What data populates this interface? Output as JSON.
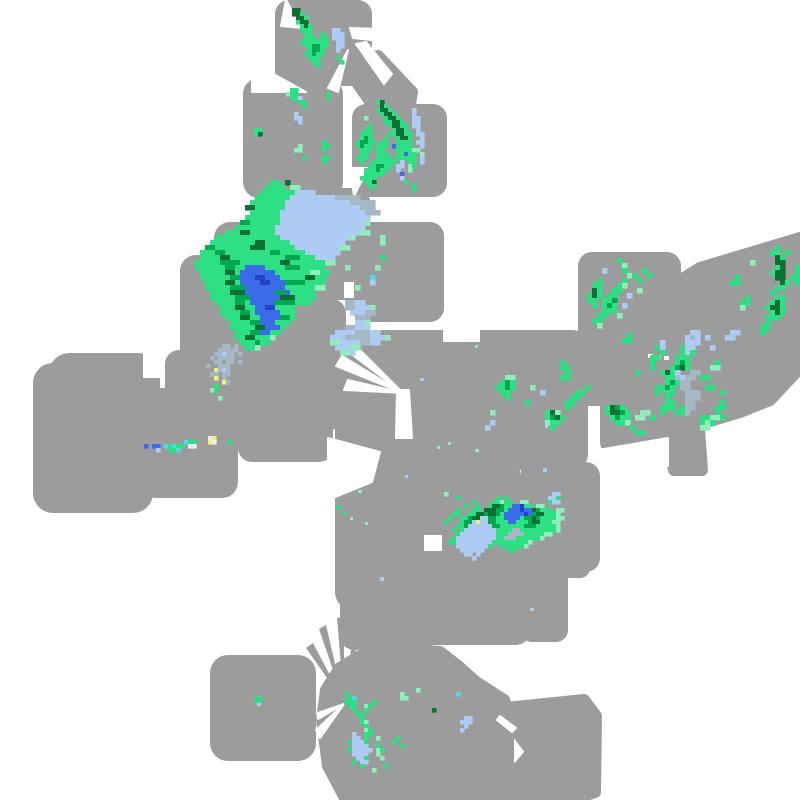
{
  "canvas": {
    "width": 800,
    "height": 800,
    "background": "#ffffff"
  },
  "palette": {
    "footprint": "#9c9c9c",
    "gap": "#ffffff",
    "b": "#aecbf3",
    "s": "#a6b7c6",
    "g": "#2ee084",
    "G": "#00a84f",
    "D": "#0b7034",
    "B": "#3a6be8",
    "N": "#2343c6",
    "c": "#52d8e6",
    "m": "#90eebb",
    "y": "#eef17c",
    "w": "#e9eff5"
  },
  "footprint_rects": [
    [
      275,
      0,
      97,
      86,
      14
    ],
    [
      243,
      78,
      100,
      120,
      16
    ],
    [
      352,
      104,
      95,
      93,
      14
    ],
    [
      266,
      188,
      104,
      112,
      14
    ],
    [
      214,
      222,
      118,
      120,
      16
    ],
    [
      180,
      255,
      106,
      130,
      16
    ],
    [
      228,
      298,
      118,
      132,
      16
    ],
    [
      238,
      380,
      95,
      82,
      14
    ],
    [
      352,
      222,
      92,
      100,
      14
    ],
    [
      335,
      330,
      185,
      145,
      16
    ],
    [
      470,
      330,
      118,
      140,
      16
    ],
    [
      600,
      336,
      66,
      118,
      12
    ],
    [
      584,
      336,
      22,
      74,
      6
    ],
    [
      578,
      252,
      103,
      100,
      14
    ],
    [
      335,
      455,
      185,
      155,
      18
    ],
    [
      520,
      462,
      80,
      110,
      14
    ],
    [
      520,
      560,
      48,
      82,
      12
    ],
    [
      540,
      548,
      50,
      30,
      10
    ],
    [
      340,
      555,
      95,
      95,
      14
    ],
    [
      390,
      560,
      140,
      85,
      14
    ],
    [
      210,
      655,
      106,
      106,
      18
    ],
    [
      33,
      363,
      120,
      150,
      20
    ],
    [
      48,
      353,
      112,
      100,
      22
    ],
    [
      140,
      388,
      98,
      110,
      16
    ],
    [
      165,
      350,
      75,
      55,
      14
    ]
  ],
  "footprint_polys": [
    [
      [
        358,
        62
      ],
      [
        378,
        56
      ],
      [
        412,
        92
      ],
      [
        410,
        104
      ],
      [
        372,
        104
      ],
      [
        358,
        84
      ]
    ],
    [
      [
        655,
        315
      ],
      [
        668,
        288
      ],
      [
        700,
        268
      ],
      [
        800,
        238
      ],
      [
        800,
        368
      ],
      [
        770,
        400
      ],
      [
        740,
        412
      ],
      [
        700,
        424
      ],
      [
        668,
        430
      ],
      [
        648,
        420
      ],
      [
        640,
        390
      ],
      [
        642,
        345
      ]
    ],
    [
      [
        664,
        428
      ],
      [
        698,
        416
      ],
      [
        702,
        470
      ],
      [
        674,
        470
      ]
    ],
    [
      [
        326,
        690
      ],
      [
        340,
        668
      ],
      [
        360,
        656
      ],
      [
        386,
        652
      ],
      [
        412,
        650
      ],
      [
        440,
        652
      ],
      [
        458,
        666
      ],
      [
        476,
        682
      ],
      [
        504,
        700
      ],
      [
        508,
        712
      ],
      [
        508,
        800
      ],
      [
        346,
        800
      ],
      [
        328,
        766
      ],
      [
        322,
        720
      ]
    ],
    [
      [
        506,
        708
      ],
      [
        584,
        700
      ],
      [
        596,
        716
      ],
      [
        595,
        792
      ],
      [
        572,
        800
      ],
      [
        520,
        800
      ],
      [
        508,
        780
      ],
      [
        532,
        752
      ],
      [
        506,
        718
      ]
    ]
  ],
  "gap_rects": [
    [
      344,
      282,
      10,
      16
    ],
    [
      424,
      535,
      18,
      16
    ],
    [
      588,
      406,
      12,
      48
    ],
    [
      143,
      350,
      20,
      28
    ],
    [
      443,
      320,
      37,
      22
    ],
    [
      648,
      354,
      5,
      4
    ],
    [
      656,
      355,
      5,
      4
    ],
    [
      664,
      356,
      5,
      4
    ]
  ],
  "gap_polys": [
    [
      [
        286,
        0
      ],
      [
        281,
        26
      ],
      [
        302,
        28
      ]
    ],
    [
      [
        350,
        28
      ],
      [
        380,
        29
      ],
      [
        380,
        41
      ],
      [
        353,
        38
      ]
    ],
    [
      [
        348,
        50
      ],
      [
        328,
        88
      ],
      [
        338,
        92
      ]
    ],
    [
      [
        356,
        44
      ],
      [
        366,
        42
      ],
      [
        392,
        74
      ],
      [
        384,
        84
      ]
    ],
    [
      [
        252,
        62
      ],
      [
        306,
        92
      ],
      [
        252,
        92
      ]
    ],
    [
      [
        350,
        168
      ],
      [
        368,
        168
      ],
      [
        354,
        196
      ]
    ],
    [
      [
        403,
        393
      ],
      [
        338,
        344
      ],
      [
        350,
        340
      ]
    ],
    [
      [
        403,
        393
      ],
      [
        342,
        356
      ],
      [
        336,
        366
      ]
    ],
    [
      [
        403,
        393
      ],
      [
        348,
        380
      ],
      [
        344,
        390
      ]
    ],
    [
      [
        397,
        390
      ],
      [
        409,
        390
      ],
      [
        412,
        438
      ],
      [
        396,
        438
      ]
    ],
    [
      [
        500,
        716
      ],
      [
        516,
        728
      ],
      [
        512,
        732
      ],
      [
        497,
        720
      ]
    ],
    [
      [
        598,
        466
      ],
      [
        598,
        450
      ],
      [
        668,
        438
      ],
      [
        668,
        466
      ]
    ],
    [
      [
        328,
        438
      ],
      [
        380,
        452
      ],
      [
        372,
        482
      ],
      [
        328,
        500
      ]
    ],
    [
      [
        344,
        704
      ],
      [
        318,
        713
      ],
      [
        318,
        719
      ]
    ],
    [
      [
        344,
        704
      ],
      [
        316,
        730
      ],
      [
        320,
        738
      ]
    ]
  ],
  "sliver_polys": [
    [
      [
        344,
        702
      ],
      [
        306,
        648
      ],
      [
        313,
        643
      ]
    ],
    [
      [
        344,
        702
      ],
      [
        319,
        629
      ],
      [
        326,
        625
      ]
    ],
    [
      [
        344,
        702
      ],
      [
        337,
        618
      ],
      [
        344,
        617
      ]
    ],
    [
      [
        344,
        702
      ],
      [
        355,
        619
      ],
      [
        362,
        622
      ]
    ],
    [
      [
        344,
        702
      ],
      [
        373,
        632
      ],
      [
        379,
        638
      ]
    ]
  ],
  "echo_regions": [
    {
      "name": "echo-north-cell",
      "x": 288,
      "y": 8,
      "cell": 4,
      "rows": [
        ".DD.............",
        ".DDg............",
        "..DDg...........",
        "..gDD...........",
        "...gDg..........",
        "...ggg.....bb...",
        "....gg..g..bbb..",
        "....ggg.gg.bbb..",
        "...ggggggg..bb..",
        "....ggGGgg..bb..",
        ".....gGGg...b...",
        "....ggGgg.......",
        ".....ggg....g...",
        "......gg.....g..",
        ".......g........"
      ]
    },
    {
      "name": "echo-square-b",
      "x": 250,
      "y": 88,
      "cell": 4,
      "rows": [
        "..........gg..........",
        ".........mgg.......g..",
        "..........ggb......g..",
        "............gg........",
        ".............g........",
        "......................",
        "...........b..........",
        "...........bb.........",
        "............b.........",
        "......................",
        ".gg...................",
        ".gD...................",
        "......................",
        "..................g...",
        "............m.....gg..",
        "...........mm.....g...",
        "......................",
        ".............g....gg..",
        "..................g...",
        "......................"
      ]
    },
    {
      "name": "echo-square-c",
      "x": 352,
      "y": 100,
      "cell": 4,
      "rows": [
        "......gD................",
        ".......Dg...............",
        "......gDDg.....b........",
        ".......gDDg....b........",
        "...m....gDDg...bb.......",
        "........ggDDg..bb.......",
        "....g....gDDgg.bb.......",
        "...gg.....gDDg..b.......",
        "..ggg....ggDDgg.bb......",
        "..gGg...g..gDDg..b......",
        ".gGGgg.gg..gggg.bb......",
        ".gGgg.ggg.Bgggg..b......",
        "..ggg.gg...ggggmm.......",
        "..gg..ggg..ggBgg.m......",
        ".ggg..gggg.ggggg.b......",
        "..g..gggggg.b.gg.b......",
        "....ggGGgg.bb.mg........",
        "...gggGgg..b..m.........",
        "...ggggg....B...........",
        "..gggg......b...........",
        "...ggD.......g..........",
        "....gg.........g........",
        "...............g........"
      ]
    },
    {
      "name": "echo-central-storm-complex",
      "x": 180,
      "y": 180,
      "cell": 5,
      "rows": [
        "..................gg.D....................",
        ".................gggg.mm..................",
        "................gggggggbbbb...............",
        "...............gggggggbbbbbbbbbsssss......",
        "..............gggggggbbbbbbbbbbbbbsssss...",
        ".............DDggggggbbbbbbbbbbbbbbbsss...",
        "..............ggggggbbbbbbbbbbbbbbbbbsss..",
        ".............gggggggbbbbbbbbbbbbbbbbbb....",
        "............GGggggggbbbbbbbbbbbbbbbbbm....",
        "...........ggggggggbbbbbbbbbbbbbbbbbb.....",
        ".........gggDDgggggbbbbbbbbbbbbbbbbbmm....",
        ".......gggggggggggggbbbbbbbbbbbbbbm.....m.",
        "......gggggggggDDgggggbbbbbbbbbbb.......m.",
        ".....GGgggggggDDDggggggbbbbbbbbbmm........",
        "....gggGGgggggggggGGgggggbbbbbbb..........",
        "....ggggDDgggggggggggGGGgggbbbb.........g.",
        "...gggggGGGGggggggggDDgggggggmm...........",
        "...ggggggGGggBBBBggggGGGggggg....m.....m..",
        "....gggggDDgBBBBBBBgggggggmmgg............",
        "....ggggggGGBBBNNBBBgggggDDgg.........c...",
        ".....ggggDDgBBBBNNBBBGGGGgggg.........b...",
        ".....gggggGGGBBBBBBBBggggggmm......m......",
        "......ggggDDDBBBBBBGGBggggg...............",
        "......gggggGGGBBBBBBDDDgggg...............",
        ".......ggggGGgBBBBBGGGGggg.......ssbb.....",
        "........gggDDggBBNNgggg..........ssbbbm...",
        "........ggggGGgBBBBBggg...........bbbss...",
        ".........gggDDggBBBBGGg............sss....",
        "..........ggggGGBBBggg.............bbm....",
        "..........gggggDDBBBg............ssbbb....",
        "...........gggGGBBgg...........bbbbsssbb..",
        "...........ggDDgggm...........bbbsssssbbbm",
        "............gggGgg............mmbbbbssbb..",
        ".............ggm...............bbbmm......",
        "................................mmb......."
      ]
    },
    {
      "name": "echo-slate-patch",
      "x": 198,
      "y": 344,
      "cell": 4,
      "rows": [
        "......ss.s......",
        ".....sssss......",
        "....ssbss.s.....",
        "...s.ssss.......",
        "....ss.ss.s.....",
        "..s..sss........",
        "....ysbs........",
        "...ss.ss........",
        "....y.s.........",
        "......ys........",
        "....g...........",
        "...mg...........",
        "................",
        ".....m..........",
        "................"
      ]
    },
    {
      "name": "echo-thin-line",
      "x": 140,
      "y": 436,
      "cell": 4,
      "rows": [
        ".................wy......",
        "...........cgg...yw...g..",
        ".B.BB.cgcgg.ww...........",
        "....b..ggc...............",
        "........................."
      ]
    },
    {
      "name": "echo-east-streaks",
      "x": 582,
      "y": 258,
      "cell": 5,
      "rows": [
        ".......g............",
        "........m...........",
        "....b...g...g.......",
        ".........mg..g......",
        "...g....g..g........",
        "..gg...gm...........",
        "..Dg..gg...m........",
        ".gDg.gg..b..........",
        ".gg.ggG.............",
        "..g.gGg.b...........",
        "....ggg.............",
        "...gg..m............",
        "..gg................",
        "...m................",
        "....................",
        ".........g..........",
        "........gg.........."
      ]
    },
    {
      "name": "echo-northeast-streaks",
      "x": 720,
      "y": 245,
      "cell": 5,
      "rows": [
        "...........g....",
        "..........gg.g..",
        "...........Dg...",
        "......m....DD...",
        "...........gD..g",
        "..........gDD..g",
        "...g.......DD.gg",
        "..gg........Dg.g",
        "...........gg...",
        "..........g.....",
        ".....g.....gg...",
        "....gg....gDg...",
        "....m....gDDg...",
        "..........gDg...",
        ".........ggg....",
        ".........g......",
        "........gg......",
        "..bb....g.......",
        ".bb.............",
        "................"
      ]
    },
    {
      "name": "echo-east-band",
      "x": 560,
      "y": 330,
      "cell": 5,
      "rows": [
        "..........................bb............",
        ".........................bsb.b..........",
        "....................b....bbb............",
        "...................gb...gbb...b.........",
        "....................g...gbg.............",
        "..................gg...ggg..............",
        "g.................g....gGg.....g........",
        "gg................g...gGDg....mm........",
        ".g.............g....gDgb..ss............",
        "gg...................ggsbss.gg..........",
        ".....................gGgss..............",
        ".....g.............ggGg.ss...gg.........",
        "...gg..............g.gg..sss....g.......",
        "..gg.................g...sss............",
        ".gg..................gg..ss.....g.......",
        ".g.......gDGg.......ggg.gss....gg.......",
        ".........gDDGg..mm..g..ggs.....g........",
        "..........gGgg.mm.g.........ggmmg.......",
        "...........ggm..............gmg.........",
        "..............g.............mm..........",
        "...............gg......................."
      ]
    },
    {
      "name": "echo-center-specks",
      "x": 470,
      "y": 370,
      "cell": 5,
      "rows": [
        "......................",
        ".......mm.............",
        "......gGg.............",
        ".....ggGg...m.........",
        "......gg......b.......",
        ".......g..............",
        "...........g..........",
        "......................",
        "....m..........gDm....",
        "...............gGDg...",
        "....b..........mgg....",
        "...b............g....."
      ]
    },
    {
      "name": "echo-south-storm",
      "x": 432,
      "y": 488,
      "cell": 4,
      "rows": [
        "........................................",
        "...m..........................bb........",
        "......g.........g.g..........bbg........",
        "..........g....ggmgg..mm.....gbb........",
        "........g..g..gDDGggBBNgg.mm............",
        "......g...gg.DDDGGgBBBNBBDGggg.mm.......",
        ".....gg..ggDDGDDGgBBBBBNBGDDgggm........",
        "....g..ggGDDbbGGggBBBBgGGDGggggmm.......",
        "...g...gGGbybbGGgggBBgggGDDgggmm........",
        "......ggGbbbbbbGGggggggGGGgggggm........",
        ".....g.gbbbbbbbbggggssgggggggggm........",
        "......gbbbbbbbbbgggssssgggggmm..........",
        ".....gbbbbbbbbbbggsssggggggm............",
        "....ggbbbbbbbbbgggggggggm...............",
        "......bbbbbbbbg..ggggggm................",
        ".......bbbbbb......gg...................",
        "........bb.b............................",
        "..........b............................."
      ]
    },
    {
      "name": "echo-south-trail",
      "x": 336,
      "y": 688,
      "cell": 4,
      "rows": [
        "....................m...............",
        "..g.............m.............c.....",
        "...gc...........mm..................",
        "..ggg....g..........................",
        "...gg..mg...........................",
        "....g..g................D...........",
        ".....gg.............................",
        "......g.........................bb..",
        "......gm.......................bbb..",
        ".......g........................b...",
        ".......mg......................b....",
        "....b..gg...........................",
        "....bb.g..m....g....................",
        "...gbbbg......g.....................",
        "....bbbb..g.....g...................",
        "...gbbbbb.mg........................",
        "....bbbb..m.........................",
        ".....bbg...m........................",
        "....g.bb............................",
        "......g.....g.......................",
        ".........m.........................."
      ]
    }
  ],
  "specks": [
    [
      255,
      696,
      7,
      8,
      "g"
    ],
    [
      257,
      703,
      4,
      3,
      "b"
    ],
    [
      380,
      577,
      4,
      4,
      "b"
    ],
    [
      543,
      468,
      4,
      4,
      "b"
    ],
    [
      545,
      425,
      3,
      3,
      "b"
    ],
    [
      475,
      449,
      4,
      3,
      "m"
    ],
    [
      437,
      446,
      3,
      3,
      "m"
    ],
    [
      358,
      490,
      4,
      3,
      "m"
    ],
    [
      336,
      505,
      5,
      4,
      "g"
    ],
    [
      342,
      512,
      4,
      3,
      "g"
    ],
    [
      350,
      517,
      3,
      3,
      "m"
    ],
    [
      365,
      522,
      3,
      3,
      "m"
    ],
    [
      405,
      475,
      3,
      3,
      "b"
    ],
    [
      420,
      378,
      4,
      3,
      "b"
    ],
    [
      448,
      442,
      3,
      3,
      "m"
    ],
    [
      530,
      608,
      4,
      3,
      "b"
    ],
    [
      475,
      345,
      3,
      3,
      "m"
    ]
  ]
}
